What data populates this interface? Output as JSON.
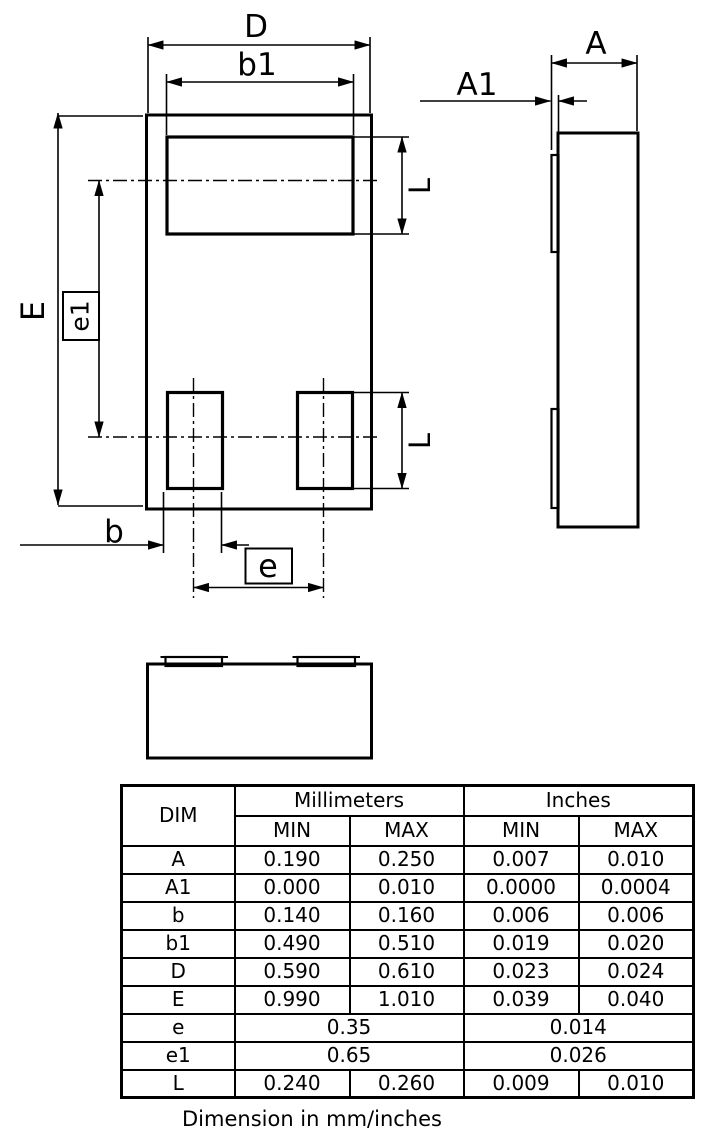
{
  "diagram": {
    "labels": {
      "D": "D",
      "b1": "b1",
      "E": "E",
      "e1": "e1",
      "b": "b",
      "e": "e",
      "L": "L",
      "A": "A",
      "A1": "A1"
    }
  },
  "table": {
    "col_dim": "DIM",
    "group_mm": "Millimeters",
    "group_in": "Inches",
    "min": "MIN",
    "max": "MAX",
    "rows": [
      {
        "dim": "A",
        "cells": [
          "0.190",
          "0.250",
          "0.007",
          "0.010"
        ]
      },
      {
        "dim": "A1",
        "cells": [
          "0.000",
          "0.010",
          "0.0000",
          "0.0004"
        ]
      },
      {
        "dim": "b",
        "cells": [
          "0.140",
          "0.160",
          "0.006",
          "0.006"
        ]
      },
      {
        "dim": "b1",
        "cells": [
          "0.490",
          "0.510",
          "0.019",
          "0.020"
        ]
      },
      {
        "dim": "D",
        "cells": [
          "0.590",
          "0.610",
          "0.023",
          "0.024"
        ]
      },
      {
        "dim": "E",
        "cells": [
          "0.990",
          "1.010",
          "0.039",
          "0.040"
        ]
      },
      {
        "dim": "e",
        "cells": [
          "0.35",
          "0.014"
        ],
        "merged": true
      },
      {
        "dim": "e1",
        "cells": [
          "0.65",
          "0.026"
        ],
        "merged": true
      },
      {
        "dim": "L",
        "cells": [
          "0.240",
          "0.260",
          "0.009",
          "0.010"
        ]
      }
    ],
    "caption": "Dimension in mm/inches"
  }
}
